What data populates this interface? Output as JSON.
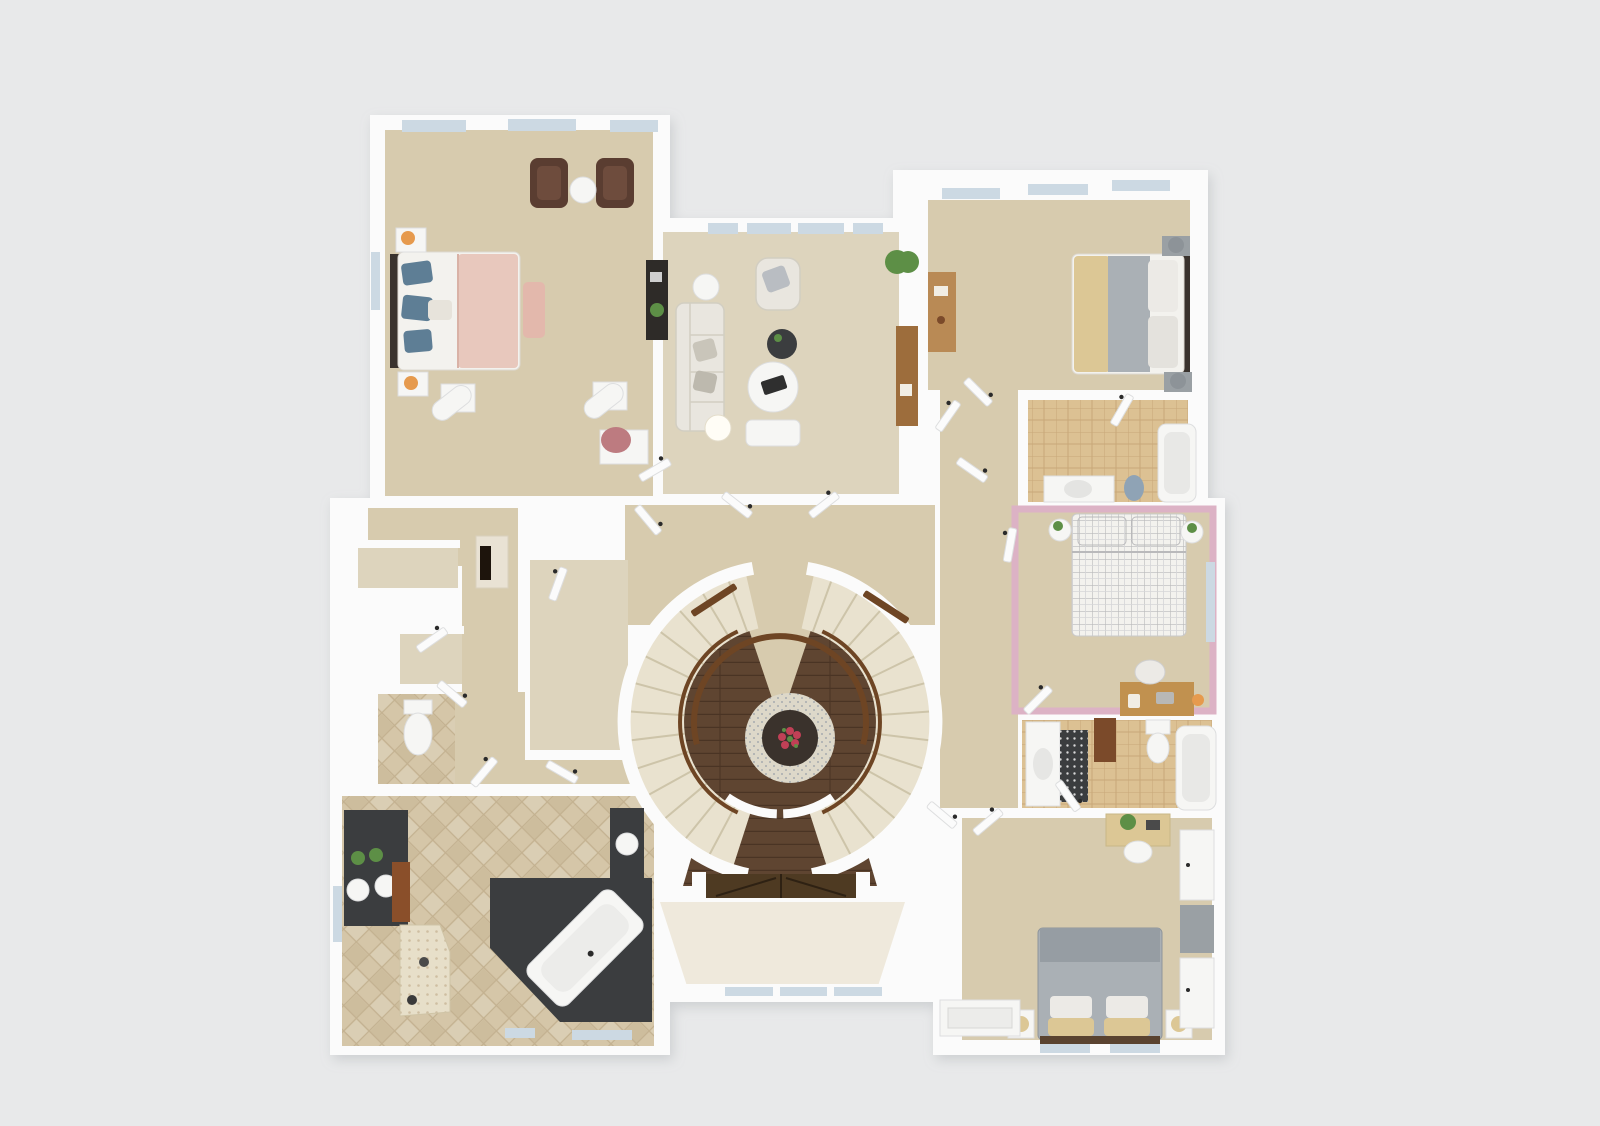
{
  "scene": {
    "kind": "3d-floor-plan-render",
    "view": "top-down dollhouse view, upper floor",
    "background": "plain light gray, no text or UI chrome",
    "notable_feature": "curved double staircase wrapping a two-story foyer with round rug and flower centerpiece, dark wood entry below"
  },
  "colors": {
    "bg": "#e8e9ea",
    "wall": "#fbfbfb",
    "wallShade": "#dddedf",
    "carpet": "#d7cbae",
    "carpetLight": "#ddd4bd",
    "stairCarpet": "#e9e2cf",
    "stairTread": "#cdc4a9",
    "tileTan": "#dcc193",
    "tileTanLine": "#c8a878",
    "marble": "#d5c6a8",
    "marbleLine": "#c3b190",
    "hexTile": "#e7dfc9",
    "pink": "#dcb2c5",
    "wood": "#5f4531",
    "woodDark": "#4a3424",
    "doorWood": "#4e3a22",
    "rail": "#6e4524",
    "charcoal": "#3b3d3f",
    "rugLight": "#ddd8c9",
    "rugDark": "#3a322c",
    "flowerRed": "#c04056",
    "plantGreen": "#5d8f46",
    "sofa": "#e9e6df",
    "sofaShadow": "#d2cec2",
    "chairBrown": "#5a3d31",
    "bedWhite": "#f3f2ee",
    "blanketPink": "#e8c8bd",
    "pillowBlue": "#5e7e95",
    "bedGray": "#aab0b5",
    "bedGrayDark": "#969da3",
    "pillowTan": "#dcc795",
    "oak": "#c1914f",
    "lampOrange": "#e69a4d",
    "fixtureWhite": "#f6f6f4",
    "glassBlue": "#ccd9e3",
    "grayFurn": "#9aa0a4",
    "benchPink": "#e3b8ac"
  },
  "rooms": [
    {
      "id": "master-bedroom",
      "position": "top-left",
      "floor": "beige carpet",
      "contents": [
        "bed with pink throw and blue pillows",
        "two nightstands with orange lamps",
        "pink bench",
        "two brown armchairs with round side table",
        "two white columns",
        "black vanity desk",
        "white desk with pink chair"
      ]
    },
    {
      "id": "sitting-room",
      "position": "top-center",
      "floor": "beige carpet",
      "contents": [
        "white sofa",
        "white armchair",
        "dark round side table",
        "round marble coffee table",
        "white ottoman bench",
        "lamp table",
        "wood console",
        "plant"
      ]
    },
    {
      "id": "bedroom-2",
      "position": "top-right",
      "floor": "beige carpet",
      "contents": [
        "bed with tan and gray bedding",
        "gray lamps on nightstands",
        "wood writing desk",
        "plant"
      ]
    },
    {
      "id": "bathroom-2",
      "position": "right, below bedroom-2",
      "floor": "tan tile",
      "contents": [
        "bathtub",
        "vanity sink",
        "toilet"
      ]
    },
    {
      "id": "pink-bedroom",
      "position": "middle-right",
      "floor": "beige carpet, pink walls",
      "contents": [
        "white grid-pattern bed",
        "two round plant stands",
        "oak desk with laptop and chair"
      ]
    },
    {
      "id": "jack-and-jill-bathroom",
      "position": "right, below pink bedroom",
      "floor": "tan tile",
      "contents": [
        "vanity sink",
        "dotted bath mat",
        "wood cabinet",
        "toilet",
        "bathtub"
      ]
    },
    {
      "id": "bedroom-3",
      "position": "bottom-right",
      "floor": "beige carpet",
      "contents": [
        "gray bed with tan pillows",
        "two nightstands with lamps",
        "desk with plant and chair",
        "white wardrobes"
      ]
    },
    {
      "id": "master-bathroom",
      "position": "bottom-left",
      "floor": "marble tile",
      "contents": [
        "charcoal double vanity with plants",
        "wood cabinet",
        "hex-tile shower",
        "charcoal platform with angled white bathtub",
        "second charcoal vanity"
      ]
    },
    {
      "id": "water-closet",
      "position": "left-middle",
      "floor": "marble tile",
      "contents": [
        "toilet"
      ]
    },
    {
      "id": "hallway-left",
      "position": "center-left",
      "floor": "beige carpet",
      "contents": [
        "double-sided fireplace",
        "linen closets"
      ]
    },
    {
      "id": "walk-in-closet",
      "position": "center",
      "floor": "light carpet",
      "contents": []
    },
    {
      "id": "staircase-foyer",
      "position": "center",
      "floor": "dark wood below, carpeted stairs",
      "contents": [
        "curved double staircase",
        "wood balcony railings",
        "round patterned rug with red flower centerpiece",
        "double entry doors",
        "bay windows"
      ]
    }
  ]
}
